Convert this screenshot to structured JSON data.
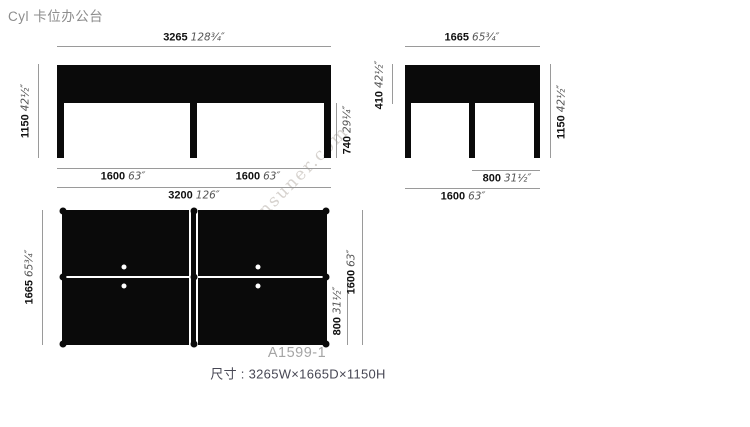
{
  "page": {
    "title": "Cyl 卡位办公台",
    "product_code": "A1599-1",
    "size_note": "尺寸 : 3265W×1665D×1150H",
    "watermark": "snsuner.com"
  },
  "colors": {
    "ink": "#0a0a0a",
    "dimension_line": "#9a9a9a",
    "mm_text": "#111111",
    "inch_text": "#555555",
    "title_text": "#8d8d8d",
    "code_text": "#a5a5a5",
    "note_text": "#474754"
  },
  "views": {
    "front": {
      "width": {
        "mm": "3265",
        "in": "128¾″"
      },
      "overall_height": {
        "mm": "1150",
        "in": "42½″"
      },
      "desk_height": {
        "mm": "740",
        "in": "29¼″"
      },
      "bay_left": {
        "mm": "1600",
        "in": "63″"
      },
      "bay_right": {
        "mm": "1600",
        "in": "63″"
      },
      "frame_width": {
        "mm": "3200",
        "in": "126″"
      }
    },
    "side": {
      "depth": {
        "mm": "1665",
        "in": "65¾″"
      },
      "screen_height": {
        "mm": "410",
        "in": "42½″"
      },
      "overall_height": {
        "mm": "1150",
        "in": "42½″"
      },
      "half_depth": {
        "mm": "800",
        "in": "31½″"
      },
      "frame_depth": {
        "mm": "1600",
        "in": "63″"
      }
    },
    "plan": {
      "depth": {
        "mm": "1665",
        "in": "65¾″"
      },
      "half_depth": {
        "mm": "800",
        "in": "31½″"
      },
      "frame_depth": {
        "mm": "1600",
        "in": "63″"
      }
    }
  }
}
